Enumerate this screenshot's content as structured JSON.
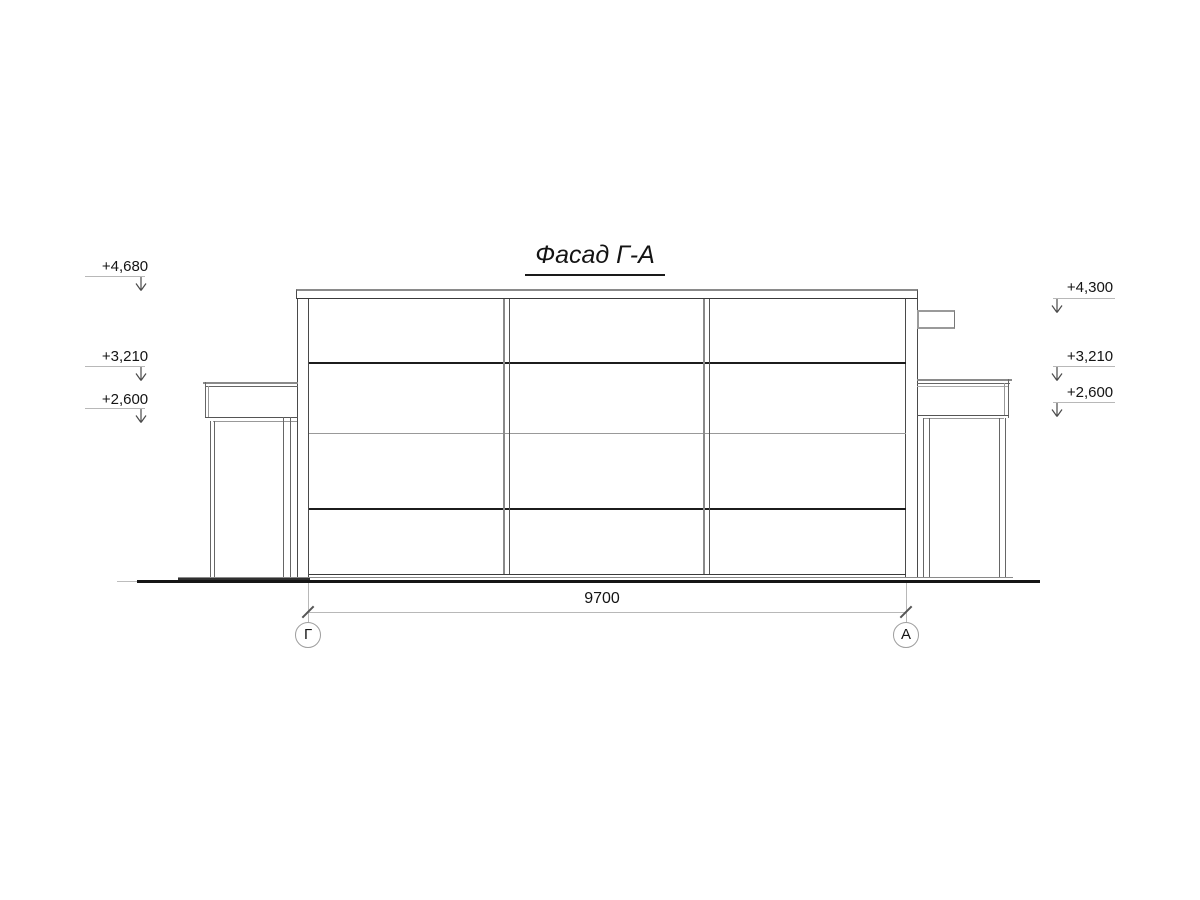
{
  "drawing": {
    "title": "Фасад Г-А",
    "elevation_marks": {
      "left": [
        {
          "label": "+4,680"
        },
        {
          "label": "+3,210"
        },
        {
          "label": "+2,600"
        }
      ],
      "right": [
        {
          "label": "+4,300"
        },
        {
          "label": "+3,210"
        },
        {
          "label": "+2,600"
        }
      ]
    },
    "dimension": {
      "value": "9700"
    },
    "axes": {
      "left": "Г",
      "right": "А"
    },
    "colors": {
      "background": "#ffffff",
      "line_dark": "#1c1c1c",
      "line_mid": "#555555",
      "line_gray": "#8a8a8a",
      "line_light": "#b8b8b8",
      "text": "#141414"
    }
  }
}
